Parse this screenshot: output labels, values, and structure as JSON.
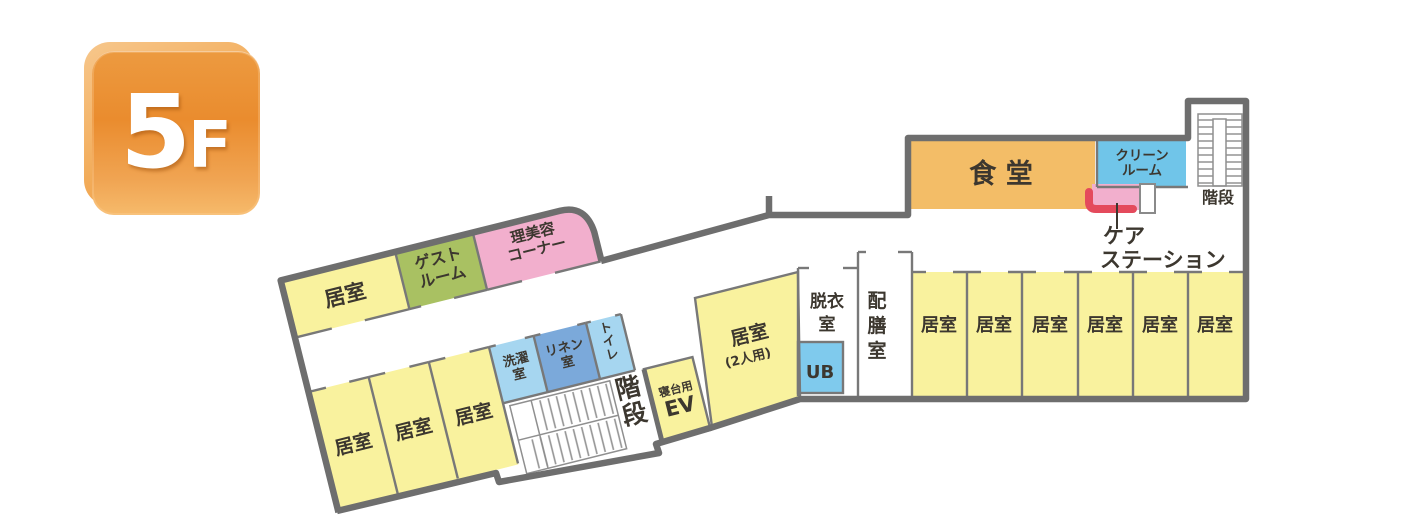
{
  "floor_badge": {
    "number": "5",
    "suffix": "F"
  },
  "colors": {
    "wall": "#6e6e6e",
    "room_yellow": "#f9f29e",
    "room_green": "#a9c162",
    "room_pink": "#f2afcd",
    "room_orange": "#f3bd67",
    "blue_light": "#a6d6f0",
    "blue_bath": "#7fcaed",
    "blue_clean": "#70c5e9",
    "blue_linen": "#7ba9da",
    "red_counter": "#e44a5c",
    "white": "#ffffff"
  },
  "left_wing": {
    "room_top": "居室",
    "guest_room_lines": [
      "ゲスト",
      "ルーム"
    ],
    "beauty_corner_lines": [
      "理美容",
      "コーナー"
    ],
    "rooms_bottom": [
      "居室",
      "居室",
      "居室"
    ],
    "laundry_lines": [
      "洗濯",
      "室"
    ],
    "linen_lines": [
      "リネン",
      "室"
    ],
    "toilet_lines": [
      "ト",
      "イ",
      "レ"
    ],
    "stairs_lines": [
      "階",
      "段"
    ],
    "bed_ev_small": "寝台用",
    "bed_ev_large": "EV"
  },
  "middle": {
    "double_room_name": "居室",
    "double_room_capacity": "(2人用)",
    "undress_lines": [
      "脱衣",
      "室"
    ],
    "unit_bath": "UB",
    "serving_lines": [
      "配",
      "膳",
      "室"
    ]
  },
  "right_wing": {
    "dining": "食 堂",
    "clean_room_lines": [
      "クリーン",
      "ルーム"
    ],
    "care_station_line1": "ケア",
    "care_station_line2": "ステーション",
    "stairs": "階段",
    "rooms": [
      "居室",
      "居室",
      "居室",
      "居室",
      "居室",
      "居室"
    ]
  }
}
